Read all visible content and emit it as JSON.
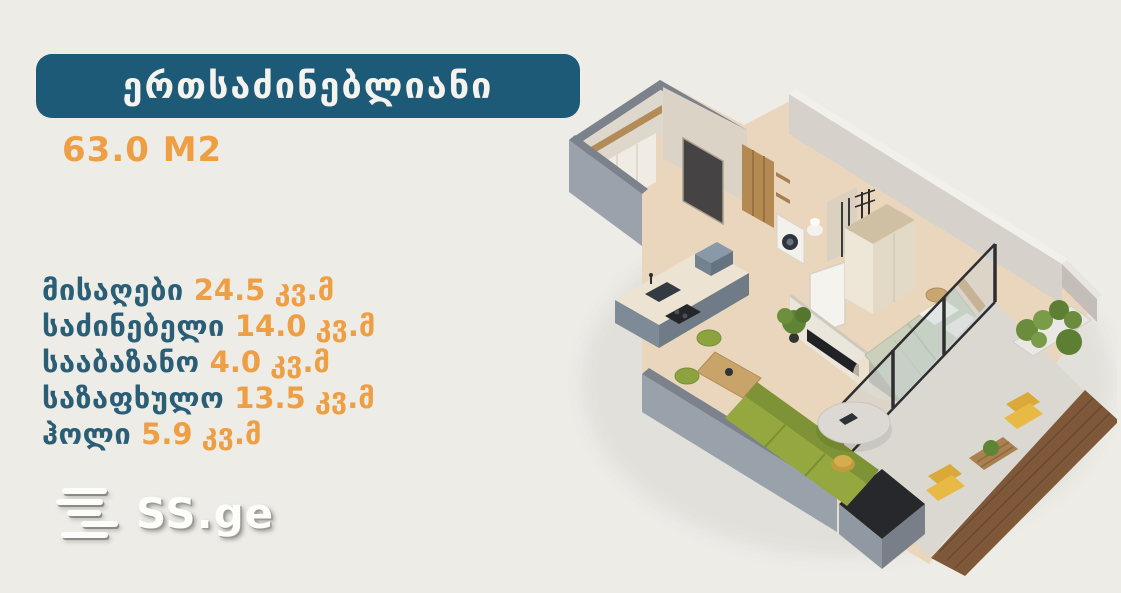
{
  "header": {
    "type_badge": "ერთსაძინებლიანი",
    "area": "63.0 M2"
  },
  "rooms": [
    {
      "label": "მისაღები",
      "value": "24.5",
      "unit": "კვ.მ"
    },
    {
      "label": "საძინებელი",
      "value": "14.0",
      "unit": "კვ.მ"
    },
    {
      "label": "სააბაზანო",
      "value": "4.0",
      "unit": "კვ.მ"
    },
    {
      "label": "საზაფხულო",
      "value": "13.5",
      "unit": "კვ.მ"
    },
    {
      "label": "ჰოლი",
      "value": "5.9",
      "unit": "კვ.მ"
    }
  ],
  "logo": {
    "text": "SS.ge"
  },
  "floorplan": {
    "alt": "3D isometric floor plan of a one-bedroom apartment"
  },
  "colors": {
    "background": "#edece7",
    "badge_bg": "#1d5a78",
    "accent_orange": "#ef9f43",
    "label_teal": "#2a5d76",
    "wall_gray": "#9ba2ab",
    "wall_cap": "#7b828b",
    "wall_cream": "#d9d2c6",
    "floor_beige": "#e9d6bd",
    "sofa_green": "#94a83f",
    "bed_sage": "#cad0bb",
    "chair_yellow": "#e8ba45",
    "parapet_wood": "#7f583a",
    "kitchen_slate": "#7e8a96"
  }
}
